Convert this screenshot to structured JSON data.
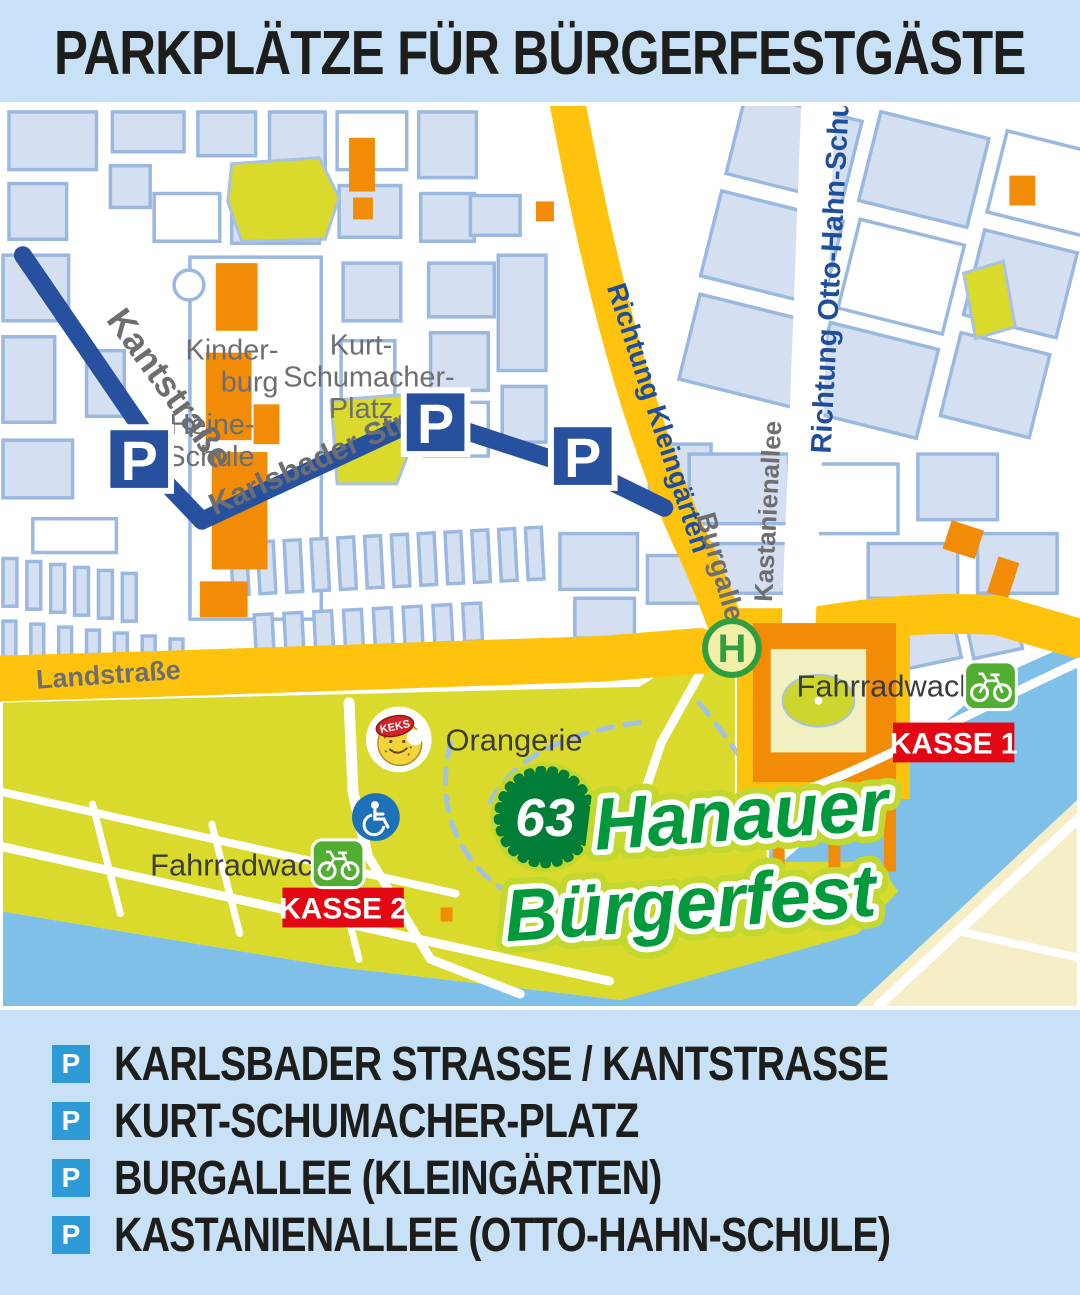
{
  "header": {
    "title": "PARKPLÄTZE FÜR BÜRGERFESTGÄSTE"
  },
  "map": {
    "streets": {
      "kantstrasse": "Kantstraße",
      "karlsbader_strasse": "Karlsbader Straße",
      "richtung_kleingaerten": "Richtung Kleingärten",
      "burgallee": "Burgallee",
      "kastanienallee": "Kastanienallee",
      "richtung_otto_hahn_schule": "Richtung Otto-Hahn-Schule",
      "landstrasse": "Landstraße"
    },
    "places": {
      "kinderburg_l1": "Kinder-",
      "kinderburg_l2": "burg",
      "kurt_l1": "Kurt-",
      "kurt_l2": "Schumacher-",
      "kurt_l3": "Platz",
      "heine_l1": "Heine-",
      "heine_l2": "Schule",
      "orangerie": "Orangerie",
      "fahrradwache": "Fahrradwache",
      "kasse1": "KASSE 1",
      "kasse2": "KASSE 2"
    },
    "markers": {
      "parking": "P",
      "bus_stop": "H",
      "keks": "KEKS"
    },
    "festival": {
      "number": "63",
      "name_l1": "Hanauer",
      "name_l2": "Bürgerfest"
    },
    "colors": {
      "road_major": "#ffc20d",
      "road_secondary": "#27519f",
      "water": "#7fc0e8",
      "park": "#d9da2c",
      "building": "#f28c07",
      "block": "#d4e0f2",
      "kasse_red": "#e30613",
      "logo_green": "#009a3d",
      "banner_blue": "#c9e1f6"
    }
  },
  "legend": {
    "items": [
      {
        "label": "KARLSBADER STRASSE / KANTSTRASSE"
      },
      {
        "label": "KURT-SCHUMACHER-PLATZ"
      },
      {
        "label": "BURGALLEE (KLEINGÄRTEN)"
      },
      {
        "label": "KASTANIENALLEE (OTTO-HAHN-SCHULE)"
      }
    ]
  }
}
